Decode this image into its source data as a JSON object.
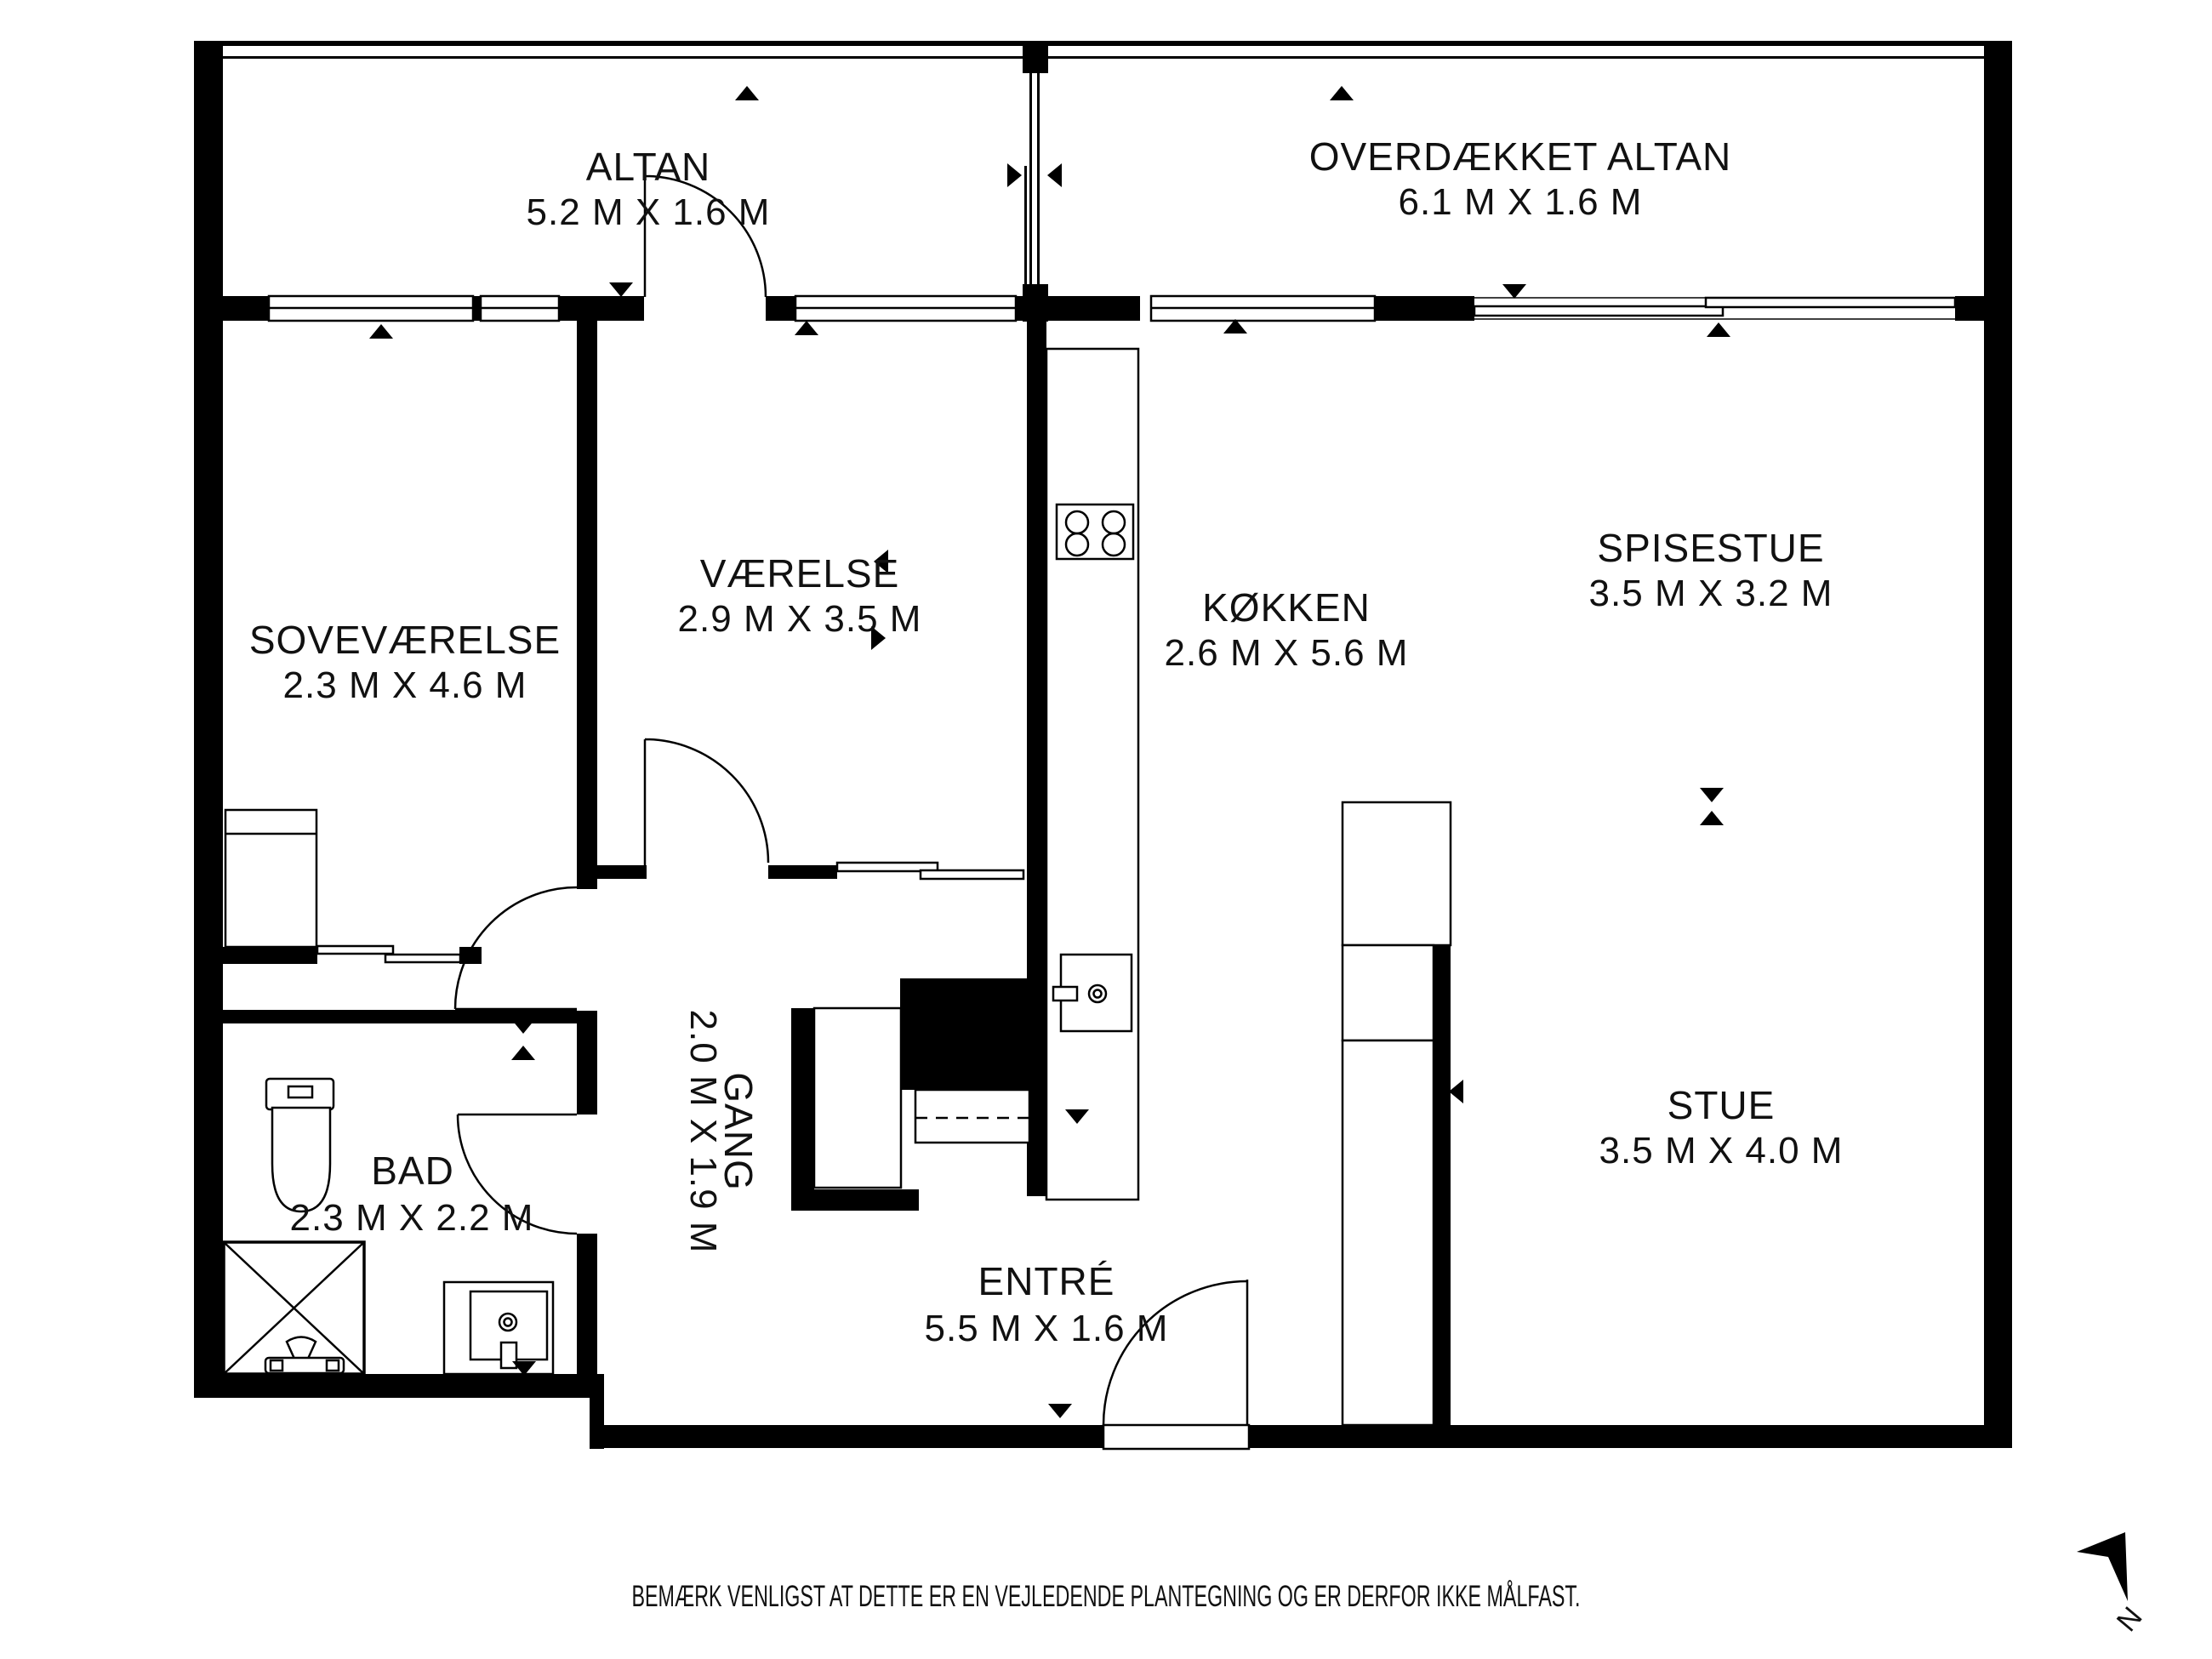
{
  "plan": {
    "rooms": [
      {
        "id": "altan",
        "name": "ALTAN",
        "dims": "5.2 M X 1.6 M"
      },
      {
        "id": "overdaekket-altan",
        "name": "OVERDÆKKET ALTAN",
        "dims": "6.1 M X 1.6 M"
      },
      {
        "id": "sovevaerelse",
        "name": "SOVEVÆRELSE",
        "dims": "2.3 M X 4.6 M"
      },
      {
        "id": "vaerelse",
        "name": "VÆRELSE",
        "dims": "2.9 M X 3.5 M"
      },
      {
        "id": "koekken",
        "name": "KØKKEN",
        "dims": "2.6 M X 5.6 M"
      },
      {
        "id": "spisestue",
        "name": "SPISESTUE",
        "dims": "3.5 M X 3.2 M"
      },
      {
        "id": "stue",
        "name": "STUE",
        "dims": "3.5 M X 4.0 M"
      },
      {
        "id": "bad",
        "name": "BAD",
        "dims": "2.3 M X 2.2 M"
      },
      {
        "id": "gang",
        "name": "GANG",
        "dims": "2.0 M X 1.9 M"
      },
      {
        "id": "entre",
        "name": "ENTRÉ",
        "dims": "5.5 M X 1.6 M"
      }
    ],
    "disclaimer": "BEMÆRK VENLIGST AT DETTE ER EN VEJLEDENDE PLANTEGNING OG ER DERFOR IKKE MÅLFAST.",
    "north_label": "N",
    "colors": {
      "wall": "#000000",
      "background": "#ffffff",
      "text": "#111111"
    },
    "icons": [
      "north-arrow-icon",
      "stove-icon",
      "kitchen-sink-icon",
      "toilet-icon",
      "shower-icon",
      "washbasin-icon"
    ]
  }
}
